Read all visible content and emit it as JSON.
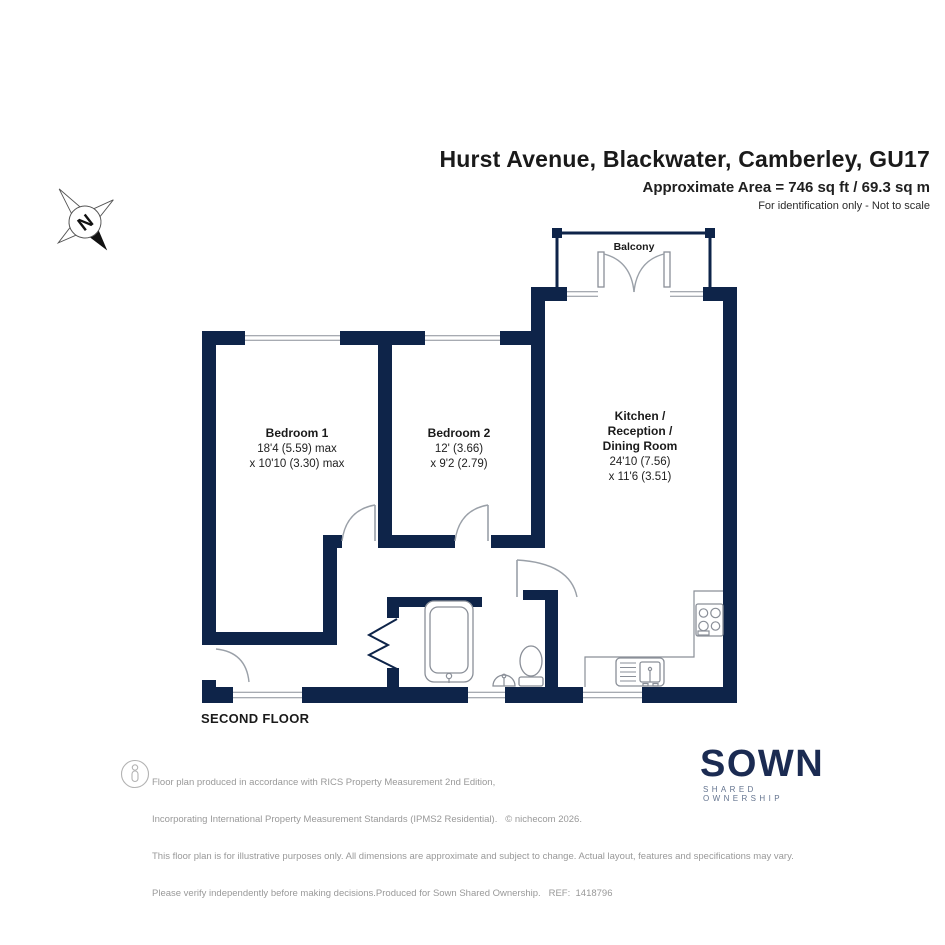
{
  "header": {
    "title": "Hurst Avenue, Blackwater, Camberley, GU17",
    "area": "Approximate Area = 746 sq ft / 69.3 sq m",
    "note": "For identification only - Not to scale"
  },
  "plan": {
    "floor_label": "SECOND FLOOR",
    "balcony_label": "Balcony",
    "compass_label": "N",
    "rooms": {
      "bedroom1": {
        "name": "Bedroom 1",
        "dim1": "18'4 (5.59) max",
        "dim2": "x 10'10 (3.30) max"
      },
      "bedroom2": {
        "name": "Bedroom 2",
        "dim1": "12' (3.66)",
        "dim2": "x 9'2 (2.79)"
      },
      "kitchen": {
        "name1": "Kitchen /",
        "name2": "Reception /",
        "name3": "Dining Room",
        "dim1": "24'10 (7.56)",
        "dim2": "x 11'6 (3.51)"
      }
    }
  },
  "footer": {
    "disclaimer": {
      "line1": "Floor plan produced in accordance with RICS Property Measurement 2nd Edition,",
      "line2": "Incorporating International Property Measurement Standards (IPMS2 Residential).   © nichecom 2026.",
      "line3": "This floor plan is for illustrative purposes only. All dimensions are approximate and subject to change. Actual layout, features and specifications may vary.",
      "line4": "Please verify independently before making decisions.Produced for Sown Shared Ownership.   REF:  1418796"
    },
    "logo": {
      "text": "SOWN",
      "subtext": "SHARED OWNERSHIP"
    }
  },
  "colors": {
    "wall": "#0e2449",
    "fixture": "#8a8f98",
    "arc": "#9aa0a8",
    "text": "#1a1a1a",
    "muted": "#999999",
    "logo": "#1b2b52"
  }
}
